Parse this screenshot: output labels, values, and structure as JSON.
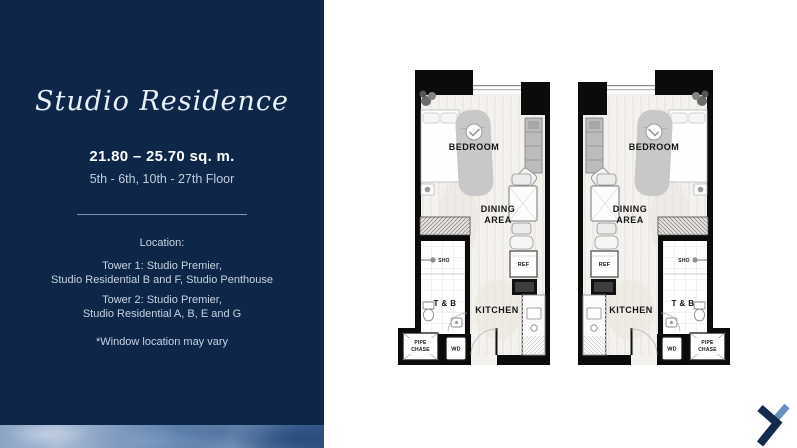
{
  "panel": {
    "title": "Studio Residence",
    "area_range": "21.80 – 25.70 sq. m.",
    "floor_range": "5th - 6th, 10th - 27th Floor",
    "location_heading": "Location:",
    "tower1": [
      "Tower 1: Studio Premier,",
      "Studio Residential B and F, Studio Penthouse"
    ],
    "tower2": [
      "Tower 2: Studio Premier,",
      "Studio Residential A, B, E and G"
    ],
    "note": "*Window location may vary"
  },
  "floor_plan": {
    "labels": {
      "bedroom": "BEDROOM",
      "dining_line1": "DINING",
      "dining_line2": "AREA",
      "kitchen": "KITCHEN",
      "toilet_bath": "T & B",
      "shower": "SHO",
      "refrigerator": "REF",
      "washer_dryer": "WD",
      "pipe_chase_line1": "PIPE",
      "pipe_chase_line2": "CHASE"
    }
  },
  "colors": {
    "panel_navy": "#0e2748",
    "wall_black": "#0b0b0b",
    "logo_dark": "#132a4d",
    "logo_light": "#6792c0"
  }
}
